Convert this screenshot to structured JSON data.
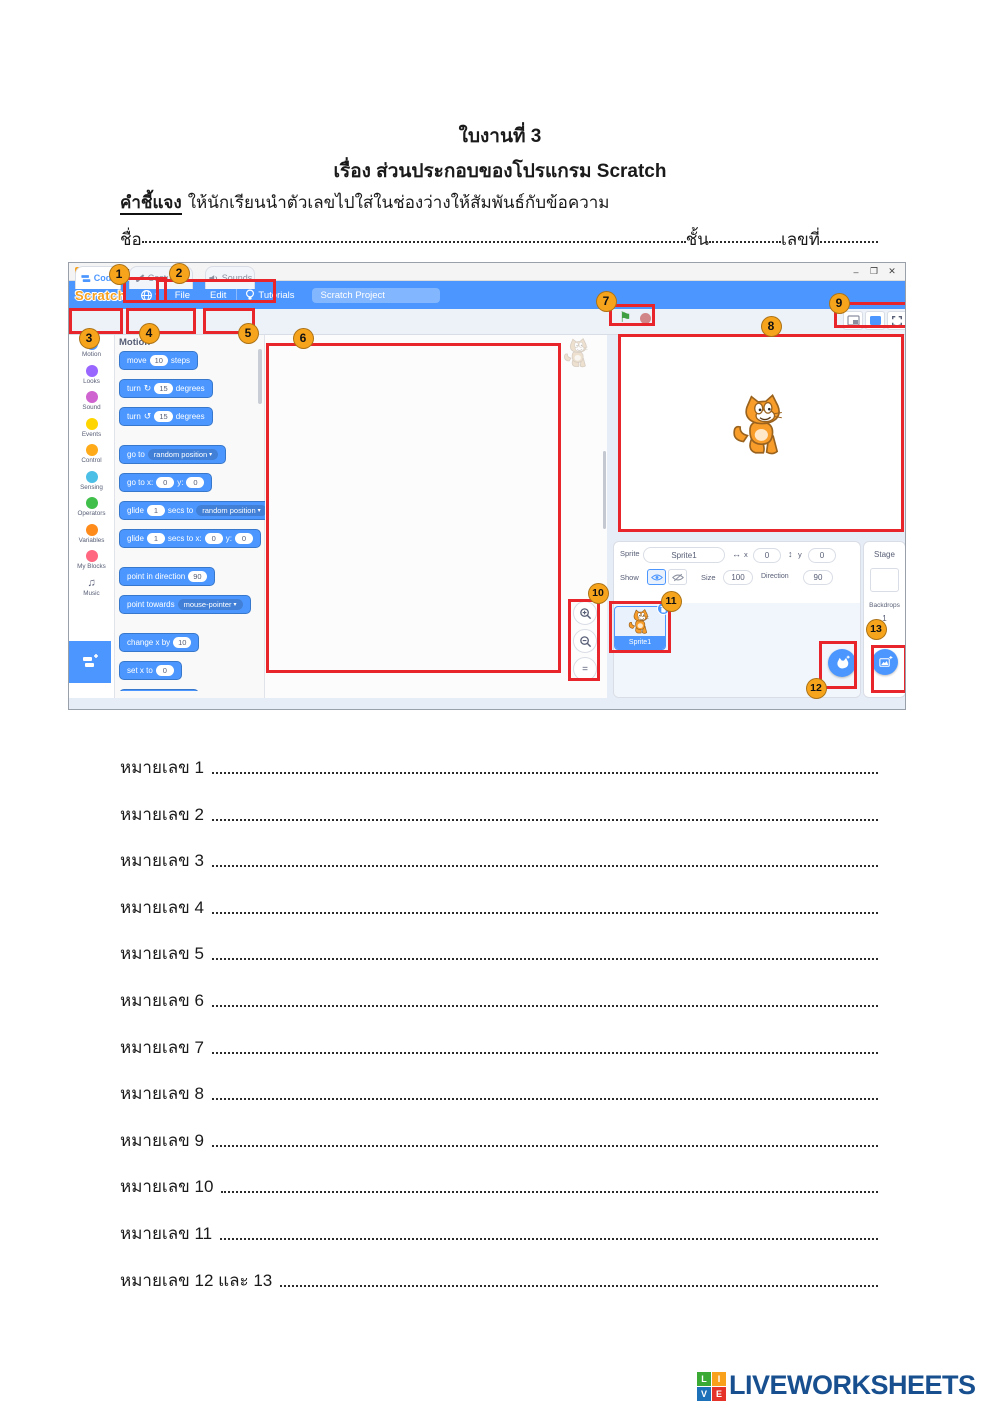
{
  "header": {
    "title": "ใบงานที่ 3",
    "subtitle": "เรื่อง ส่วนประกอบของโปรแกรม Scratch",
    "instruction_label": "คำชี้แจง",
    "instruction_text": "ให้นักเรียนนำตัวเลขไปใส่ในช่องว่างให้สัมพันธ์กับข้อความ",
    "name_label": "ชื่อ",
    "class_label": "ชั้น",
    "no_label": "เลขที่"
  },
  "window": {
    "title": "Scratch 3.19.1",
    "controls": {
      "minimize": "–",
      "restore": "❐",
      "close": "✕"
    },
    "logo": "Scratch",
    "flag_icon": "⚑",
    "menu": {
      "file": "File",
      "edit": "Edit",
      "tutorials": "Tutorials",
      "project_name": "Scratch Project"
    },
    "tabs": {
      "code": "Code",
      "costumes": "Costumes",
      "sounds": "Sounds"
    }
  },
  "palette": {
    "header": "Motion",
    "categories": [
      {
        "label": "Motion",
        "color": "#4C97FF"
      },
      {
        "label": "Looks",
        "color": "#9966FF"
      },
      {
        "label": "Sound",
        "color": "#CF63CF"
      },
      {
        "label": "Events",
        "color": "#FFD500"
      },
      {
        "label": "Control",
        "color": "#FFAB19"
      },
      {
        "label": "Sensing",
        "color": "#4CBFE6"
      },
      {
        "label": "Operators",
        "color": "#40BF4A"
      },
      {
        "label": "Variables",
        "color": "#FF8C1A"
      },
      {
        "label": "My Blocks",
        "color": "#FF6680"
      },
      {
        "label": "Music",
        "color": "",
        "icon": "♫"
      }
    ],
    "blocks": [
      {
        "gap": false,
        "parts": [
          {
            "t": "txt",
            "v": "move"
          },
          {
            "t": "num",
            "v": "10"
          },
          {
            "t": "txt",
            "v": "steps"
          }
        ]
      },
      {
        "gap": false,
        "parts": [
          {
            "t": "txt",
            "v": "turn"
          },
          {
            "t": "ic",
            "v": "↻"
          },
          {
            "t": "num",
            "v": "15"
          },
          {
            "t": "txt",
            "v": "degrees"
          }
        ]
      },
      {
        "gap": false,
        "parts": [
          {
            "t": "txt",
            "v": "turn"
          },
          {
            "t": "ic",
            "v": "↺"
          },
          {
            "t": "num",
            "v": "15"
          },
          {
            "t": "txt",
            "v": "degrees"
          }
        ]
      },
      {
        "gap": true,
        "parts": [
          {
            "t": "txt",
            "v": "go to"
          },
          {
            "t": "drop",
            "v": "random position"
          }
        ]
      },
      {
        "gap": false,
        "parts": [
          {
            "t": "txt",
            "v": "go to x:"
          },
          {
            "t": "num",
            "v": "0"
          },
          {
            "t": "txt",
            "v": "y:"
          },
          {
            "t": "num",
            "v": "0"
          }
        ]
      },
      {
        "gap": false,
        "parts": [
          {
            "t": "txt",
            "v": "glide"
          },
          {
            "t": "num",
            "v": "1"
          },
          {
            "t": "txt",
            "v": "secs to"
          },
          {
            "t": "drop",
            "v": "random position"
          }
        ]
      },
      {
        "gap": false,
        "parts": [
          {
            "t": "txt",
            "v": "glide"
          },
          {
            "t": "num",
            "v": "1"
          },
          {
            "t": "txt",
            "v": "secs to x:"
          },
          {
            "t": "num",
            "v": "0"
          },
          {
            "t": "txt",
            "v": "y:"
          },
          {
            "t": "num",
            "v": "0"
          }
        ]
      },
      {
        "gap": true,
        "parts": [
          {
            "t": "txt",
            "v": "point in direction"
          },
          {
            "t": "num",
            "v": "90"
          }
        ]
      },
      {
        "gap": false,
        "parts": [
          {
            "t": "txt",
            "v": "point towards"
          },
          {
            "t": "drop",
            "v": "mouse-pointer"
          }
        ]
      },
      {
        "gap": true,
        "parts": [
          {
            "t": "txt",
            "v": "change x by"
          },
          {
            "t": "num",
            "v": "10"
          }
        ]
      },
      {
        "gap": false,
        "parts": [
          {
            "t": "txt",
            "v": "set x to"
          },
          {
            "t": "num",
            "v": "0"
          }
        ]
      },
      {
        "gap": false,
        "parts": [
          {
            "t": "txt",
            "v": "change y by"
          },
          {
            "t": "num",
            "v": "10"
          }
        ]
      }
    ]
  },
  "sprite_panel": {
    "sprite_label": "Sprite",
    "sprite_name": "Sprite1",
    "x_icon": "↔",
    "x_label": "x",
    "x_value": "0",
    "y_icon": "↕",
    "y_label": "y",
    "y_value": "0",
    "show_label": "Show",
    "size_label": "Size",
    "size_value": "100",
    "direction_label": "Direction",
    "direction_value": "90",
    "thumb_name": "Sprite1"
  },
  "stage_panel": {
    "title": "Stage",
    "backdrops_label": "Backdrops",
    "backdrops_count": "1"
  },
  "annotations": {
    "badge_color": "#F7A41D",
    "box_color": "#E8252A",
    "badges": [
      {
        "n": "1",
        "x": 50,
        "y": 11
      },
      {
        "n": "2",
        "x": 110,
        "y": 10
      },
      {
        "n": "3",
        "x": 20,
        "y": 75
      },
      {
        "n": "4",
        "x": 80,
        "y": 70
      },
      {
        "n": "5",
        "x": 179,
        "y": 70
      },
      {
        "n": "6",
        "x": 234,
        "y": 75
      },
      {
        "n": "7",
        "x": 537,
        "y": 38
      },
      {
        "n": "8",
        "x": 702,
        "y": 63
      },
      {
        "n": "9",
        "x": 770,
        "y": 40
      },
      {
        "n": "10",
        "x": 529,
        "y": 330
      },
      {
        "n": "11",
        "x": 602,
        "y": 338
      },
      {
        "n": "12",
        "x": 747,
        "y": 425
      },
      {
        "n": "13",
        "x": 807,
        "y": 366
      }
    ],
    "boxes": [
      {
        "x": 54,
        "y": 14,
        "w": 44,
        "h": 26
      },
      {
        "x": 87,
        "y": 16,
        "w": 120,
        "h": 24
      },
      {
        "x": 0,
        "y": 45,
        "w": 54,
        "h": 26
      },
      {
        "x": 57,
        "y": 45,
        "w": 70,
        "h": 26
      },
      {
        "x": 134,
        "y": 45,
        "w": 52,
        "h": 26
      },
      {
        "x": 197,
        "y": 80,
        "w": 295,
        "h": 330
      },
      {
        "x": 540,
        "y": 41,
        "w": 46,
        "h": 22
      },
      {
        "x": 549,
        "y": 71,
        "w": 286,
        "h": 198
      },
      {
        "x": 765,
        "y": 39,
        "w": 76,
        "h": 26
      },
      {
        "x": 499,
        "y": 336,
        "w": 32,
        "h": 82
      },
      {
        "x": 540,
        "y": 338,
        "w": 62,
        "h": 52
      },
      {
        "x": 750,
        "y": 378,
        "w": 38,
        "h": 48
      },
      {
        "x": 802,
        "y": 382,
        "w": 36,
        "h": 48
      }
    ]
  },
  "answers": {
    "rows": [
      {
        "label": "หมายเลข 1"
      },
      {
        "label": "หมายเลข 2"
      },
      {
        "label": "หมายเลข 3"
      },
      {
        "label": "หมายเลข 4"
      },
      {
        "label": "หมายเลข 5"
      },
      {
        "label": "หมายเลข 6"
      },
      {
        "label": "หมายเลข 7"
      },
      {
        "label": "หมายเลข 8"
      },
      {
        "label": "หมายเลข 9"
      },
      {
        "label": "หมายเลข 10"
      },
      {
        "label": "หมายเลข 11"
      },
      {
        "label": "หมายเลข 12 และ 13"
      }
    ]
  },
  "footer": {
    "brand": "LIVEWORKSHEETS",
    "brand_color": "#174F8F",
    "squares": [
      {
        "ch": "L",
        "color": "#3AAA35"
      },
      {
        "ch": "I",
        "color": "#F9A11B"
      },
      {
        "ch": "V",
        "color": "#1D71B8"
      },
      {
        "ch": "E",
        "color": "#E5332A"
      }
    ]
  }
}
